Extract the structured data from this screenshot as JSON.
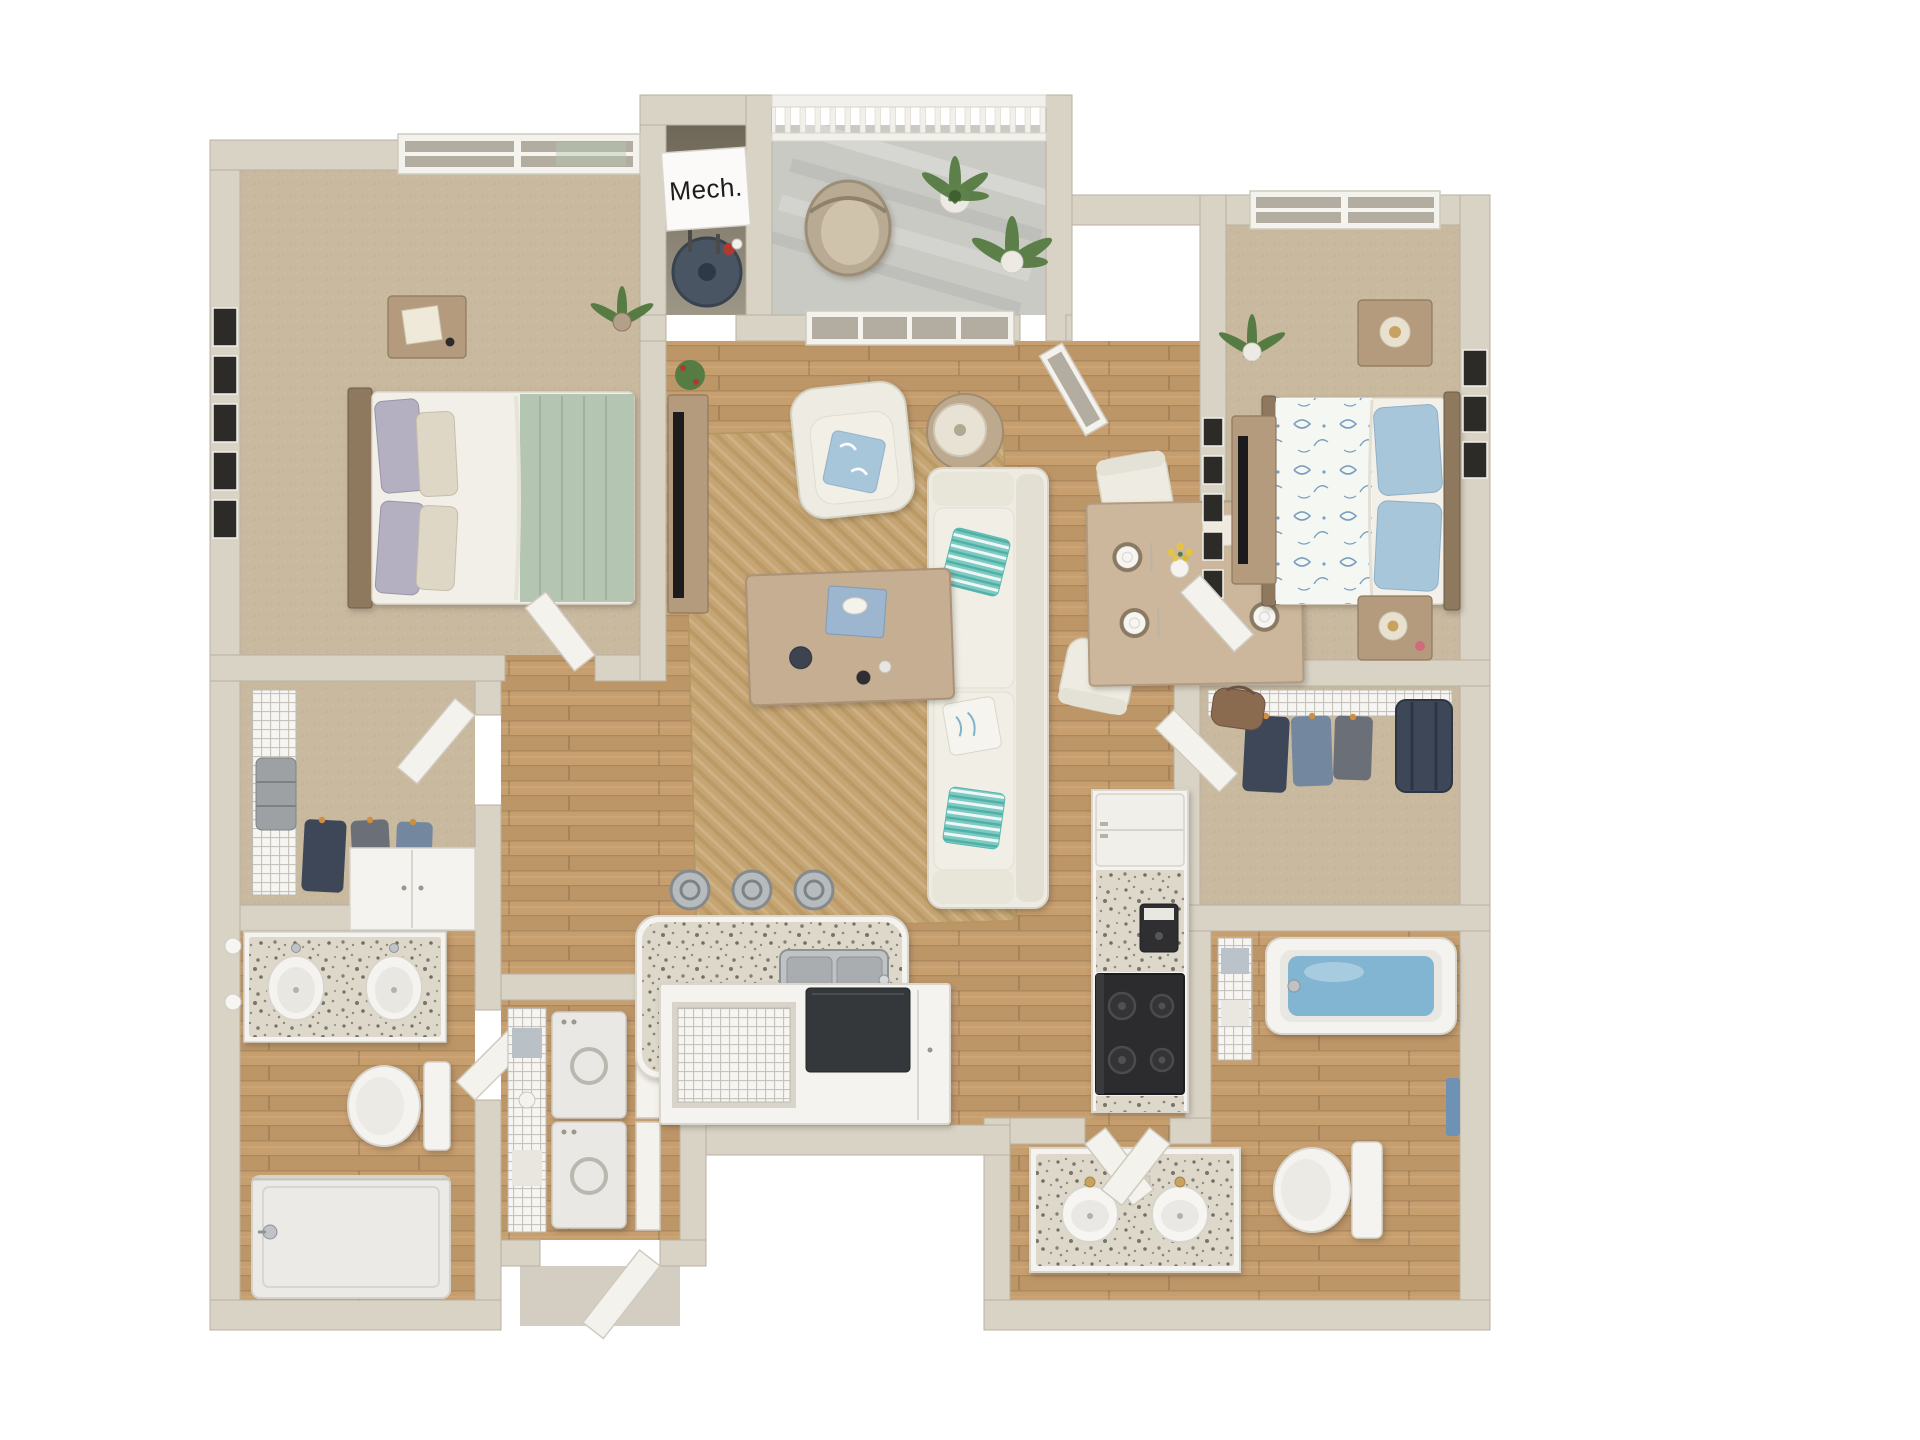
{
  "labels": {
    "mech_closet": "Mech."
  },
  "palette": {
    "wall": "#d9d3c5",
    "wall_edge": "#b9b1a1",
    "wood": "#c79e6e",
    "carpet": "#c8b99f",
    "concrete": "#c9cac4",
    "jute": "#c6a572",
    "jute_dark": "#ad8f5c",
    "granite": "#ddd8ca",
    "white_furn": "#eeece2",
    "white_furn_edge": "#d6d2c4",
    "door_white": "#f4f2ec",
    "door_edge": "#cfcabf",
    "fixture_white": "#f4f3ef",
    "fixture_edge": "#d8d5cd",
    "steel": "#c0c3c5",
    "steel_dark": "#8f9396",
    "appliance_black": "#2c2c2f",
    "wood_furn": "#b49b7e",
    "wood_furn_dark": "#8e795f",
    "teal": "#7ec9c2",
    "teal_deep": "#4fb0a6",
    "soft_blue": "#a8c6da",
    "floral_blue": "#7c9fc0",
    "sage": "#b4c6b2",
    "glass": "#b2ada0",
    "plant": "#577c43",
    "plant_dark": "#3f6132",
    "heater": "#4a5563",
    "water": "#82b5d2",
    "gold": "#c8a260",
    "navy": "#3e4758",
    "cloth_grey": "#6b7078",
    "cloth_blue": "#73889f",
    "cloth_brown": "#8a6b4f",
    "hanger_orange": "#cf8f3f",
    "frame_dark": "#2d2b28",
    "accent_red": "#b03a30",
    "towel_blue": "#6e92b4",
    "label_text": "#1c1c1c",
    "label_bg": "#fbfaf8"
  },
  "rooms": [
    {
      "id": "bedroom-1",
      "furniture": [
        "queen-bed",
        "nightstand-with-lamp",
        "gallery-frames",
        "window",
        "corner-plant"
      ]
    },
    {
      "id": "closet-1",
      "furniture": [
        "wire-shelving",
        "suitcase",
        "hanging-clothes"
      ]
    },
    {
      "id": "bathroom-1",
      "furniture": [
        "double-vanity",
        "wall-sconces",
        "toilet",
        "walk-in-shower",
        "storage-cabinet"
      ]
    },
    {
      "id": "laundry-closet",
      "furniture": [
        "stacked-washer-dryer",
        "wire-shelf-with-towels",
        "closet-doors"
      ]
    },
    {
      "id": "mech-closet",
      "furniture": [
        "water-heater"
      ],
      "label": "Mech."
    },
    {
      "id": "balcony",
      "furniture": [
        "railing",
        "wicker-chair",
        "potted-plants"
      ]
    },
    {
      "id": "living-room",
      "furniture": [
        "sofa-with-pillows",
        "armchair",
        "coffee-table",
        "side-table-lamp",
        "tv-console",
        "jute-rug",
        "window",
        "glass-door"
      ]
    },
    {
      "id": "dining-area",
      "furniture": [
        "dining-table",
        "chairs",
        "place-settings",
        "flower-vase"
      ]
    },
    {
      "id": "kitchen",
      "furniture": [
        "granite-island",
        "double-sink",
        "bar-stools",
        "refrigerator",
        "range",
        "coffee-maker",
        "base-cabinets",
        "wire-basket-cart"
      ]
    },
    {
      "id": "bedroom-2",
      "furniture": [
        "queen-bed-floral",
        "two-nightstands-with-lamps",
        "dresser-with-tv",
        "gallery-frames",
        "window",
        "plant"
      ]
    },
    {
      "id": "walk-in-closet",
      "furniture": [
        "wire-shelving",
        "hanging-clothes",
        "suitcase",
        "duffel-bag"
      ]
    },
    {
      "id": "bathroom-2",
      "furniture": [
        "bathtub",
        "double-vanity",
        "toilet",
        "linen-shelf",
        "towel"
      ]
    },
    {
      "id": "entry",
      "furniture": [
        "entry-door"
      ]
    }
  ]
}
